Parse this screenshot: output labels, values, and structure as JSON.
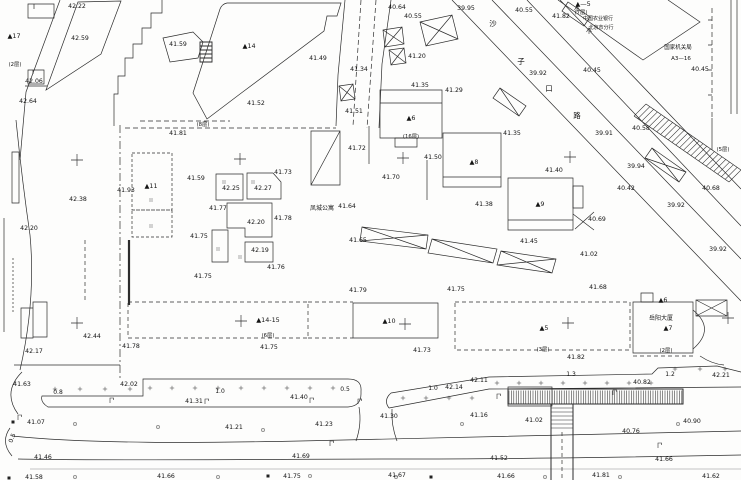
{
  "meta": {
    "type": "topographic-survey-map",
    "ink": "#2c2c2c",
    "text_color": "#141414",
    "background": "#fdfdfc"
  },
  "spot_elevations": [
    {
      "x": 77,
      "y": 6,
      "v": "42.22"
    },
    {
      "x": 80,
      "y": 38,
      "v": "42.59"
    },
    {
      "x": 178,
      "y": 44,
      "v": "41.59"
    },
    {
      "x": 34,
      "y": 81,
      "v": "42.06"
    },
    {
      "x": 28,
      "y": 101,
      "v": "42.64"
    },
    {
      "x": 397,
      "y": 7,
      "v": "40.64"
    },
    {
      "x": 413,
      "y": 16,
      "v": "40.55"
    },
    {
      "x": 466,
      "y": 8,
      "v": "39.95"
    },
    {
      "x": 524,
      "y": 10,
      "v": "40.55"
    },
    {
      "x": 561,
      "y": 16,
      "v": "41.82"
    },
    {
      "x": 538,
      "y": 73,
      "v": "39.92"
    },
    {
      "x": 592,
      "y": 70,
      "v": "40.45"
    },
    {
      "x": 700,
      "y": 69,
      "v": "40.45"
    },
    {
      "x": 318,
      "y": 58,
      "v": "41.49"
    },
    {
      "x": 417,
      "y": 56,
      "v": "41.20"
    },
    {
      "x": 420,
      "y": 85,
      "v": "41.35"
    },
    {
      "x": 454,
      "y": 90,
      "v": "41.29"
    },
    {
      "x": 256,
      "y": 103,
      "v": "41.52"
    },
    {
      "x": 354,
      "y": 111,
      "v": "41.51"
    },
    {
      "x": 359,
      "y": 69,
      "v": "41.34"
    },
    {
      "x": 357,
      "y": 148,
      "v": "41.72"
    },
    {
      "x": 391,
      "y": 177,
      "v": "41.70"
    },
    {
      "x": 347,
      "y": 206,
      "v": "41.64"
    },
    {
      "x": 433,
      "y": 157,
      "v": "41.50"
    },
    {
      "x": 484,
      "y": 204,
      "v": "41.38"
    },
    {
      "x": 512,
      "y": 133,
      "v": "41.35"
    },
    {
      "x": 554,
      "y": 170,
      "v": "41.40"
    },
    {
      "x": 641,
      "y": 128,
      "v": "40.58"
    },
    {
      "x": 604,
      "y": 133,
      "v": "39.91"
    },
    {
      "x": 636,
      "y": 166,
      "v": "39.94"
    },
    {
      "x": 626,
      "y": 188,
      "v": "40.42"
    },
    {
      "x": 676,
      "y": 205,
      "v": "39.92"
    },
    {
      "x": 711,
      "y": 188,
      "v": "40.68"
    },
    {
      "x": 597,
      "y": 219,
      "v": "40.69"
    },
    {
      "x": 283,
      "y": 172,
      "v": "41.73"
    },
    {
      "x": 231,
      "y": 188,
      "v": "42.25"
    },
    {
      "x": 263,
      "y": 188,
      "v": "42.27"
    },
    {
      "x": 218,
      "y": 208,
      "v": "41.77"
    },
    {
      "x": 256,
      "y": 222,
      "v": "42.20"
    },
    {
      "x": 283,
      "y": 218,
      "v": "41.78"
    },
    {
      "x": 260,
      "y": 250,
      "v": "42.19"
    },
    {
      "x": 196,
      "y": 178,
      "v": "41.59"
    },
    {
      "x": 126,
      "y": 190,
      "v": "41.93"
    },
    {
      "x": 78,
      "y": 199,
      "v": "42.38"
    },
    {
      "x": 29,
      "y": 228,
      "v": "42.20"
    },
    {
      "x": 178,
      "y": 133,
      "v": "41.81"
    },
    {
      "x": 199,
      "y": 236,
      "v": "41.75"
    },
    {
      "x": 203,
      "y": 276,
      "v": "41.75"
    },
    {
      "x": 92,
      "y": 336,
      "v": "42.44"
    },
    {
      "x": 34,
      "y": 351,
      "v": "42.17"
    },
    {
      "x": 131,
      "y": 346,
      "v": "41.78"
    },
    {
      "x": 276,
      "y": 267,
      "v": "41.76"
    },
    {
      "x": 358,
      "y": 290,
      "v": "41.79"
    },
    {
      "x": 456,
      "y": 289,
      "v": "41.75"
    },
    {
      "x": 269,
      "y": 347,
      "v": "41.75"
    },
    {
      "x": 422,
      "y": 350,
      "v": "41.73"
    },
    {
      "x": 529,
      "y": 241,
      "v": "41.45"
    },
    {
      "x": 589,
      "y": 254,
      "v": "41.02"
    },
    {
      "x": 598,
      "y": 287,
      "v": "41.68"
    },
    {
      "x": 718,
      "y": 249,
      "v": "39.92"
    },
    {
      "x": 358,
      "y": 240,
      "v": "41.65"
    },
    {
      "x": 22,
      "y": 384,
      "v": "41.63"
    },
    {
      "x": 129,
      "y": 384,
      "v": "42.02"
    },
    {
      "x": 194,
      "y": 401,
      "v": "41.31"
    },
    {
      "x": 36,
      "y": 422,
      "v": "41.07"
    },
    {
      "x": 234,
      "y": 427,
      "v": "41.21"
    },
    {
      "x": 43,
      "y": 457,
      "v": "41.46"
    },
    {
      "x": 34,
      "y": 477,
      "v": "41.58"
    },
    {
      "x": 166,
      "y": 476,
      "v": "41.66"
    },
    {
      "x": 299,
      "y": 397,
      "v": "41.40"
    },
    {
      "x": 324,
      "y": 424,
      "v": "41.23"
    },
    {
      "x": 454,
      "y": 387,
      "v": "42.14"
    },
    {
      "x": 479,
      "y": 380,
      "v": "42.11"
    },
    {
      "x": 389,
      "y": 416,
      "v": "41.30"
    },
    {
      "x": 479,
      "y": 415,
      "v": "41.16"
    },
    {
      "x": 301,
      "y": 456,
      "v": "41.69"
    },
    {
      "x": 292,
      "y": 476,
      "v": "41.75"
    },
    {
      "x": 397,
      "y": 475,
      "v": "41.67"
    },
    {
      "x": 642,
      "y": 382,
      "v": "40.82"
    },
    {
      "x": 534,
      "y": 420,
      "v": "41.02"
    },
    {
      "x": 631,
      "y": 431,
      "v": "40.76"
    },
    {
      "x": 692,
      "y": 421,
      "v": "40.90"
    },
    {
      "x": 499,
      "y": 458,
      "v": "41.52"
    },
    {
      "x": 664,
      "y": 459,
      "v": "41.66"
    },
    {
      "x": 601,
      "y": 475,
      "v": "41.81"
    },
    {
      "x": 506,
      "y": 476,
      "v": "41.66"
    },
    {
      "x": 711,
      "y": 476,
      "v": "41.62"
    },
    {
      "x": 721,
      "y": 375,
      "v": "42.21"
    },
    {
      "x": 576,
      "y": 357,
      "v": "41.82"
    }
  ],
  "building_labels": [
    {
      "x": 14,
      "y": 36,
      "t": "▲17"
    },
    {
      "x": 249,
      "y": 46,
      "t": "▲14"
    },
    {
      "x": 151,
      "y": 186,
      "t": "▲11"
    },
    {
      "x": 411,
      "y": 118,
      "t": "▲6"
    },
    {
      "x": 474,
      "y": 162,
      "t": "▲8"
    },
    {
      "x": 540,
      "y": 204,
      "t": "▲9"
    },
    {
      "x": 389,
      "y": 321,
      "t": "▲10"
    },
    {
      "x": 268,
      "y": 320,
      "t": "▲14-15"
    },
    {
      "x": 544,
      "y": 328,
      "t": "▲5"
    },
    {
      "x": 668,
      "y": 328,
      "t": "▲7"
    },
    {
      "x": 663,
      "y": 300,
      "t": "▲6"
    },
    {
      "x": 583,
      "y": 4,
      "t": "▲—5"
    }
  ],
  "floor_notes": [
    {
      "x": 203,
      "y": 124,
      "t": "(8层)"
    },
    {
      "x": 723,
      "y": 149,
      "t": "(5层)"
    },
    {
      "x": 411,
      "y": 136,
      "t": "(16层)"
    },
    {
      "x": 581,
      "y": 12,
      "t": "(7层)"
    },
    {
      "x": 268,
      "y": 335,
      "t": "(6层)"
    },
    {
      "x": 543,
      "y": 349,
      "t": "(3层)"
    },
    {
      "x": 666,
      "y": 350,
      "t": "(2层)"
    },
    {
      "x": 15,
      "y": 64,
      "t": "(2层)"
    }
  ],
  "annotations": [
    {
      "x": 322,
      "y": 208,
      "t": "凤城公寓",
      "size": 6
    },
    {
      "x": 598,
      "y": 18,
      "t": "中国农业银行",
      "size": 5
    },
    {
      "x": 601,
      "y": 27,
      "t": "北京市分行",
      "size": 5
    },
    {
      "x": 678,
      "y": 47,
      "t": "国家机关局",
      "size": 5.5
    },
    {
      "x": 681,
      "y": 58,
      "t": "A3—16",
      "size": 5.5
    },
    {
      "x": 661,
      "y": 318,
      "t": "岳阳大厦",
      "size": 6
    }
  ],
  "street_name": {
    "name": "沙子口路",
    "chars": [
      {
        "x": 493,
        "y": 24,
        "t": "沙"
      },
      {
        "x": 521,
        "y": 62,
        "t": "子"
      },
      {
        "x": 549,
        "y": 89,
        "t": "口"
      },
      {
        "x": 577,
        "y": 116,
        "t": "路"
      }
    ]
  },
  "distance_labels": [
    {
      "x": 58,
      "y": 392,
      "t": "0.8",
      "rot": 0
    },
    {
      "x": 220,
      "y": 391,
      "t": "1.0",
      "rot": 0
    },
    {
      "x": 345,
      "y": 389,
      "t": "0.5",
      "rot": 0
    },
    {
      "x": 433,
      "y": 388,
      "t": "1.0",
      "rot": 0
    },
    {
      "x": 571,
      "y": 374,
      "t": "1.3",
      "rot": 0
    },
    {
      "x": 670,
      "y": 374,
      "t": "1.2",
      "rot": 0
    },
    {
      "x": 12,
      "y": 438,
      "t": "0.5",
      "rot": -70
    }
  ],
  "crosses": [
    [
      77,
      160
    ],
    [
      240,
      159
    ],
    [
      403,
      158
    ],
    [
      570,
      157
    ],
    [
      77,
      323
    ],
    [
      241,
      321
    ],
    [
      405,
      324
    ],
    [
      568,
      323
    ],
    [
      728,
      318
    ]
  ],
  "symbols": {
    "plus_marks": [
      [
        150,
        388
      ],
      [
        172,
        388
      ],
      [
        195,
        388
      ],
      [
        218,
        388
      ],
      [
        241,
        388
      ],
      [
        264,
        388
      ],
      [
        287,
        388
      ],
      [
        310,
        388
      ],
      [
        333,
        388
      ],
      [
        55,
        389
      ],
      [
        80,
        389
      ],
      [
        105,
        389
      ],
      [
        130,
        389
      ],
      [
        497,
        383
      ],
      [
        519,
        383
      ],
      [
        541,
        383
      ],
      [
        563,
        383
      ],
      [
        585,
        383
      ],
      [
        607,
        383
      ],
      [
        629,
        383
      ],
      [
        651,
        383
      ],
      [
        403,
        398
      ],
      [
        426,
        398
      ],
      [
        449,
        398
      ],
      [
        472,
        398
      ],
      [
        675,
        369
      ],
      [
        700,
        369
      ],
      [
        725,
        369
      ]
    ],
    "tree_marks": [
      [
        75,
        424
      ],
      [
        158,
        427
      ],
      [
        263,
        430
      ],
      [
        462,
        424
      ],
      [
        678,
        424
      ],
      [
        75,
        477
      ],
      [
        218,
        477
      ],
      [
        310,
        476
      ],
      [
        396,
        477
      ],
      [
        545,
        477
      ],
      [
        620,
        477
      ]
    ],
    "lamps": [
      [
        110,
        403
      ],
      [
        205,
        404
      ],
      [
        310,
        403
      ],
      [
        358,
        404
      ],
      [
        497,
        399
      ],
      [
        613,
        395
      ],
      [
        330,
        446
      ],
      [
        658,
        448
      ],
      [
        18,
        420
      ]
    ],
    "squares": [
      [
        13,
        422
      ],
      [
        268,
        476
      ],
      [
        431,
        477
      ],
      [
        9,
        478
      ]
    ],
    "conifers": [
      [
        577,
        9
      ],
      [
        589,
        31
      ]
    ],
    "ticks": [
      [
        224,
        182
      ],
      [
        253,
        182
      ],
      [
        240,
        257
      ],
      [
        151,
        200
      ],
      [
        151,
        226
      ],
      [
        218,
        249
      ]
    ]
  },
  "hatch": {
    "footbridge": {
      "x1": 509,
      "x2": 682,
      "y1": 390.5,
      "y2": 403.5,
      "step": 2.4
    },
    "slope_band": {
      "e1": [
        646,
        104,
        741,
        170
      ],
      "e2": [
        634,
        116,
        729,
        182
      ],
      "n": 26
    },
    "ramp_rungs": {
      "x1": 551,
      "x2": 573,
      "y_start": 408,
      "y_end": 428,
      "step": 4
    }
  }
}
